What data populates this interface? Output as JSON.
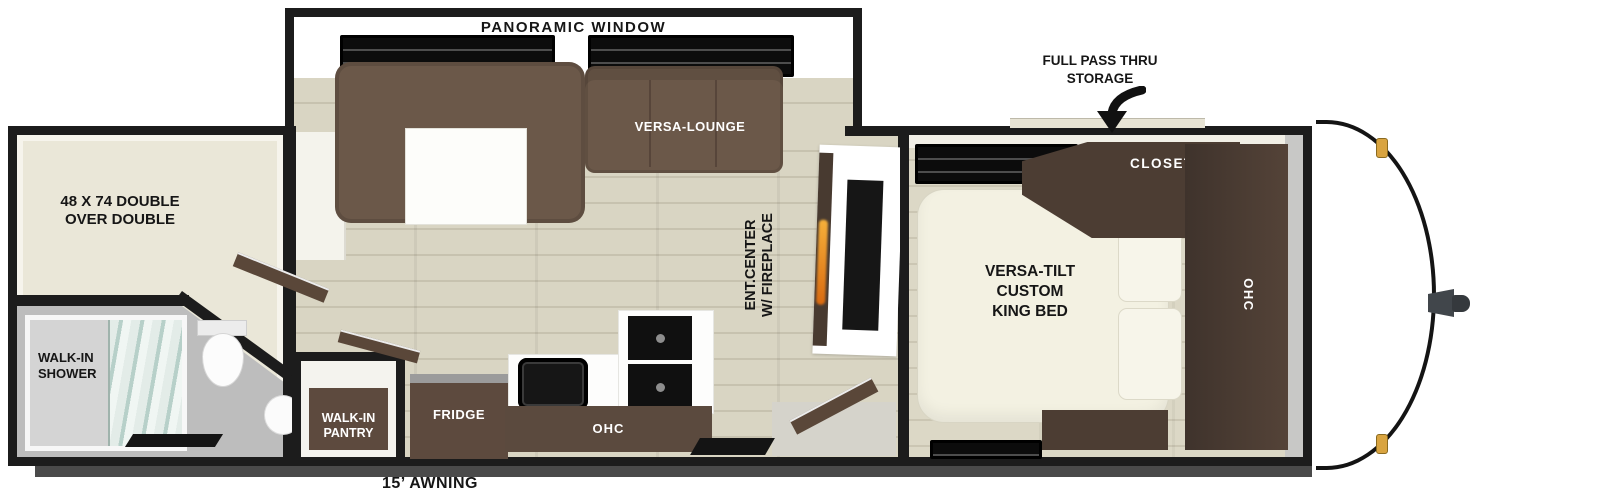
{
  "title": "Travel trailer floor plan",
  "labels": {
    "panoramic_window": "PANORAMIC WINDOW",
    "full_pass_thru": [
      "FULL PASS THRU",
      "STORAGE"
    ],
    "versa_lounge": "VERSA-LOUNGE",
    "bunk_bed": [
      "48 X 74 DOUBLE",
      "OVER DOUBLE"
    ],
    "ent_center": [
      "ENT.CENTER",
      "W/ FIREPLACE"
    ],
    "closet": "CLOSET",
    "king_bed": [
      "VERSA-TILT",
      "CUSTOM",
      "KING BED"
    ],
    "ohc_bedroom": "OHC",
    "fridge": "FRIDGE",
    "ohc_kitchen": "OHC",
    "walk_in_shower": [
      "WALK-IN",
      "SHOWER"
    ],
    "walk_in_pantry": [
      "WALK-IN",
      "PANTRY"
    ],
    "awning": "15’ AWNING"
  },
  "colors": {
    "wall": "#1c1c1c",
    "wood_floor": "#d9d5c3",
    "cabinet_brown": "#5d4a3e",
    "dark_brown": "#4c3d33",
    "sofa_brown": "#6b5849",
    "bath_floor_gray": "#bdbdbd",
    "fireplace_flame": "#e8922a",
    "marker_light_amber": "#d9a440"
  }
}
